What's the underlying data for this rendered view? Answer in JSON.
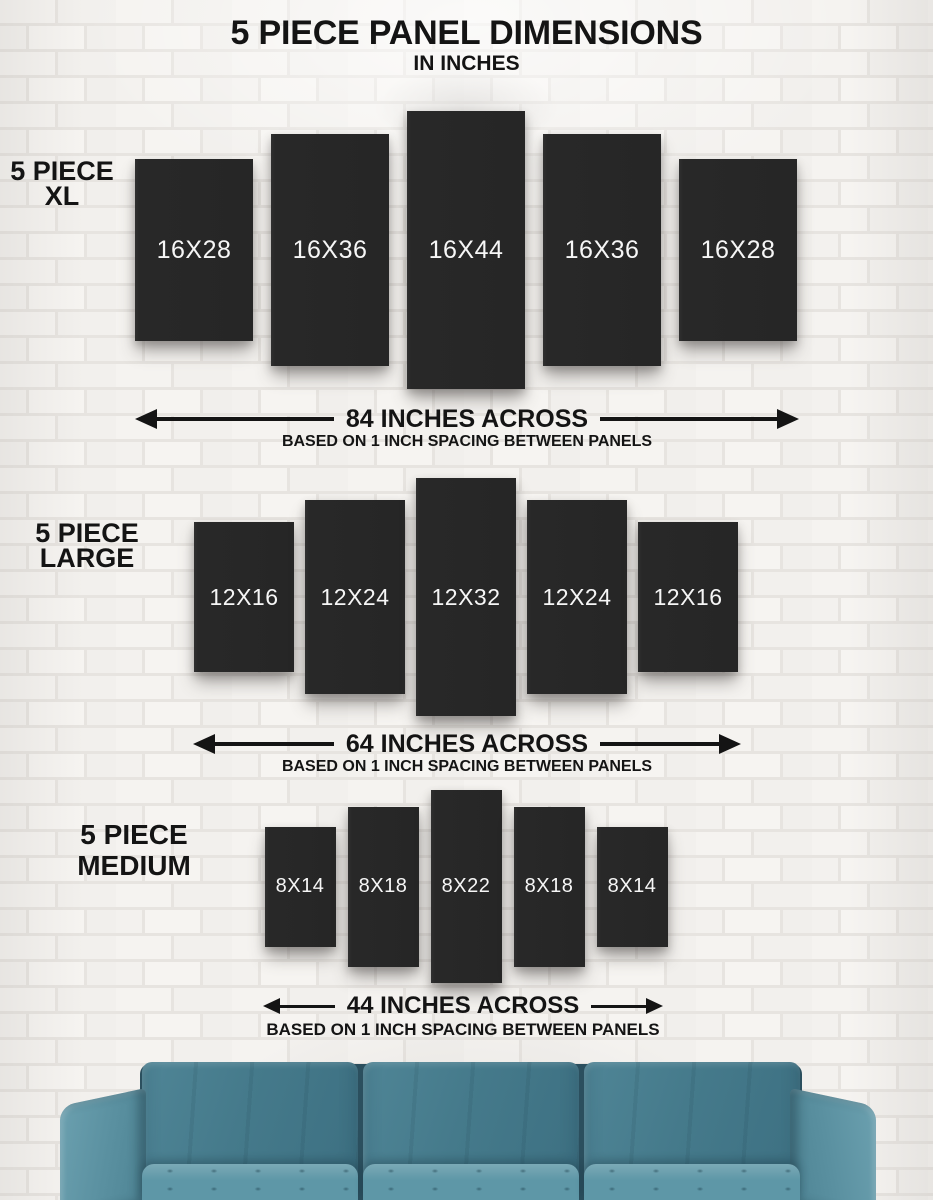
{
  "title": {
    "main": "5 PIECE PANEL DIMENSIONS",
    "sub": "IN INCHES"
  },
  "sections": [
    {
      "name": "xl",
      "label_line1": "5 PIECE",
      "label_line2": "XL",
      "panels": [
        "16X28",
        "16X36",
        "16X44",
        "16X36",
        "16X28"
      ],
      "arrow_label": "84 INCHES ACROSS",
      "arrow_note": "BASED ON 1 INCH SPACING BETWEEN PANELS"
    },
    {
      "name": "large",
      "label_line1": "5 PIECE",
      "label_line2": "LARGE",
      "panels": [
        "12X16",
        "12X24",
        "12X32",
        "12X24",
        "12X16"
      ],
      "arrow_label": "64 INCHES ACROSS",
      "arrow_note": "BASED ON 1 INCH SPACING BETWEEN PANELS"
    },
    {
      "name": "medium",
      "label_line1": "5 PIECE",
      "label_line2": "MEDIUM",
      "panels": [
        "8X14",
        "8X18",
        "8X22",
        "8X18",
        "8X14"
      ],
      "arrow_label": "44 INCHES ACROSS",
      "arrow_note": "BASED ON 1 INCH SPACING BETWEEN PANELS"
    }
  ],
  "colors": {
    "panel": "#262626",
    "panel_text": "#f6f6f6",
    "text": "#141414",
    "wall": "#f2f0ed",
    "mortar": "#e7e4e0",
    "sofa_back": "#45798a",
    "sofa_arm": "#5a90a0",
    "sofa_seat": "#5e97a7"
  }
}
